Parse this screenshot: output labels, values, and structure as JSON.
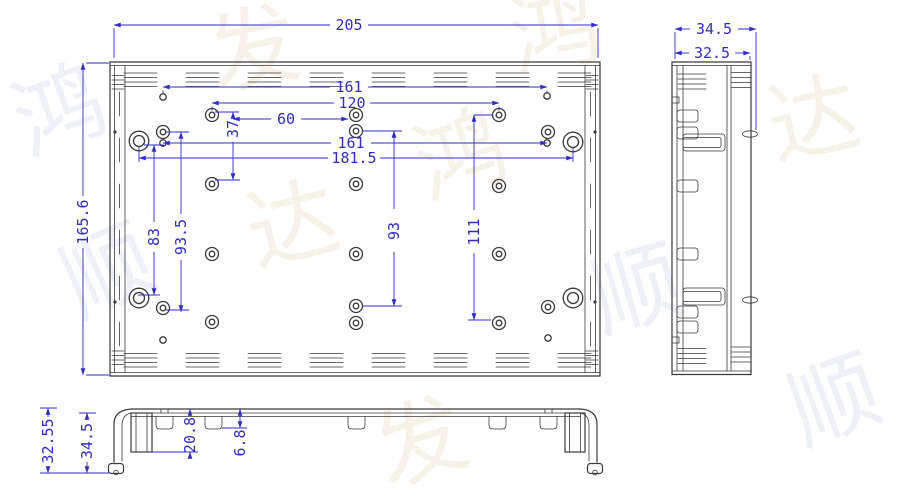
{
  "colors": {
    "part_line": "#3a3a3a",
    "dimension": "#2e2ed0",
    "background": "#ffffff",
    "watermark_warm": "#f0e9d6",
    "watermark_cool": "#dfe5f0"
  },
  "views": {
    "front": {
      "dims": {
        "width": "205",
        "height": "165.6",
        "top_span": "161",
        "span120": "120",
        "span60": "60",
        "offset37": "37",
        "mid_span": "161",
        "outer_span": "181.5",
        "left_span83": "83",
        "left_span935": "93.5",
        "mid_span93": "93",
        "right_span111": "111"
      }
    },
    "side": {
      "dims": {
        "overall_depth": "34.5",
        "inner_depth": "32.5"
      }
    },
    "bottom": {
      "dims": {
        "height3255": "32.55",
        "height345": "34.5",
        "depth208": "20.8",
        "depth68": "6.8"
      }
    }
  },
  "watermark": {
    "glyphs": [
      "鸿",
      "发",
      "顺",
      "达"
    ]
  }
}
